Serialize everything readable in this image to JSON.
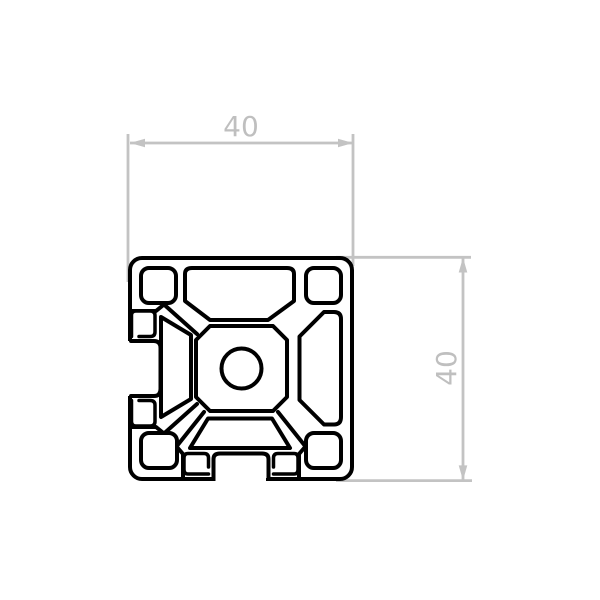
{
  "drawing": {
    "kind": "extrusion-profile-cross-section",
    "dimensions": {
      "width_label": "40",
      "height_label": "40"
    },
    "colors": {
      "profile_line": "#000000",
      "dimension_line": "#c3c3c3",
      "dimension_text": "#bfbfbf",
      "background": "#ffffff"
    }
  }
}
